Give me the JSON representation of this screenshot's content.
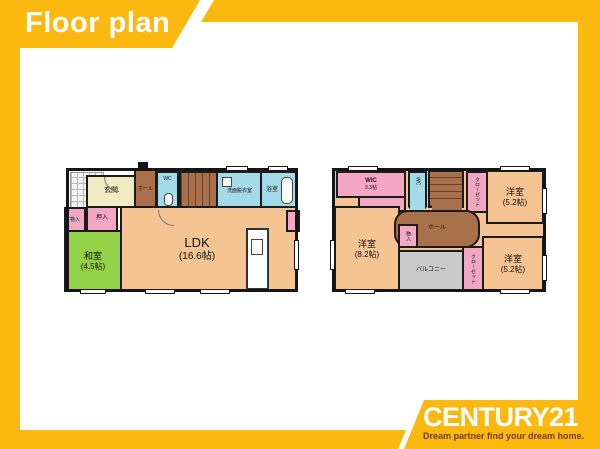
{
  "header": {
    "title": "Floor plan"
  },
  "logo": {
    "brand": "CENTURY21",
    "tagline": "Dream partner find your dream home."
  },
  "colors": {
    "accent_yellow": "#FBB90F",
    "room_orange": "#F6C492",
    "room_green": "#93D147",
    "room_blue": "#A5DBE8",
    "room_pink": "#F4A7C3",
    "hall_brown": "#A9714B",
    "genkan_cream": "#F2ECC5",
    "balcony_grey": "#C9C9C9",
    "tagline_brown": "#713A00"
  },
  "floor1": {
    "genkan": "玄関",
    "hall": "ホール",
    "wc": "WC",
    "washroom": "洗面脱衣室",
    "bath": "浴室",
    "storage": "物入",
    "oshiire": "押入",
    "washitsu": {
      "name": "和室",
      "size": "(4.5帖)"
    },
    "ldk": {
      "name": "LDK",
      "size": "(16.6帖)"
    }
  },
  "floor2": {
    "wic": {
      "name": "WIC",
      "size": "3.3帖"
    },
    "wc": "WC",
    "hall": "ホール",
    "storage": "物入",
    "bedroom_ne": {
      "name": "洋室",
      "size": "(5.2帖)"
    },
    "bedroom_w": {
      "name": "洋室",
      "size": "(8.2帖)"
    },
    "bedroom_se": {
      "name": "洋室",
      "size": "(5.2帖)"
    },
    "balcony": "バルコニー",
    "closet_ne": "クローゼット",
    "closet_se": "クローゼット"
  }
}
